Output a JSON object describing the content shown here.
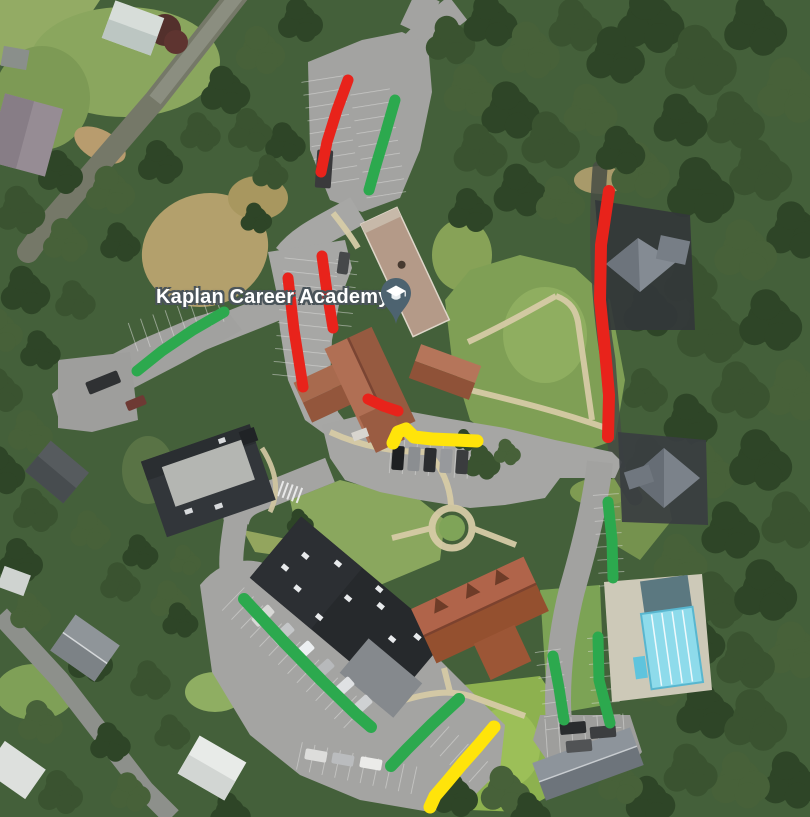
{
  "map": {
    "type": "satellite-imagery",
    "place": {
      "label": "Kaplan Career Academy",
      "label_x": 156,
      "label_y": 286,
      "label_color": "#ffffff",
      "label_halo": "#4a545a",
      "marker_icon": "graduation-cap",
      "marker_color": "#4d6370",
      "marker_x": 380,
      "marker_y": 277
    }
  },
  "annotations": {
    "colors": {
      "red": "#e8231b",
      "green": "#2ca94e",
      "yellow": "#ffe40a"
    },
    "stroke_width": 11,
    "lines": [
      {
        "id": "red-upper-lot",
        "color": "red",
        "width": 11,
        "points": [
          [
            348,
            80
          ],
          [
            337,
            110
          ],
          [
            327,
            142
          ],
          [
            321,
            172
          ]
        ]
      },
      {
        "id": "red-front-row-east",
        "color": "red",
        "width": 11,
        "points": [
          [
            322,
            256
          ],
          [
            327,
            292
          ],
          [
            333,
            328
          ]
        ]
      },
      {
        "id": "red-front-row-west",
        "color": "red",
        "width": 11,
        "points": [
          [
            288,
            278
          ],
          [
            294,
            330
          ],
          [
            303,
            387
          ]
        ]
      },
      {
        "id": "red-school-south",
        "color": "red",
        "width": 11,
        "points": [
          [
            368,
            399
          ],
          [
            383,
            406
          ],
          [
            398,
            411
          ]
        ]
      },
      {
        "id": "red-east-drive",
        "color": "red",
        "width": 12,
        "points": [
          [
            609,
            191
          ],
          [
            601,
            245
          ],
          [
            600,
            300
          ],
          [
            605,
            350
          ],
          [
            609,
            395
          ],
          [
            608,
            437
          ]
        ]
      },
      {
        "id": "green-upper-lot",
        "color": "green",
        "width": 11,
        "points": [
          [
            395,
            100
          ],
          [
            385,
            135
          ],
          [
            376,
            165
          ],
          [
            369,
            190
          ]
        ]
      },
      {
        "id": "green-west-row",
        "color": "green",
        "width": 11,
        "points": [
          [
            224,
            312
          ],
          [
            193,
            330
          ],
          [
            162,
            351
          ],
          [
            137,
            371
          ]
        ]
      },
      {
        "id": "green-east-row-upper",
        "color": "green",
        "width": 11,
        "points": [
          [
            608,
            502
          ],
          [
            612,
            540
          ],
          [
            613,
            578
          ]
        ]
      },
      {
        "id": "green-lower-lot-long",
        "color": "green",
        "width": 12,
        "points": [
          [
            244,
            599
          ],
          [
            283,
            641
          ],
          [
            322,
            681
          ],
          [
            356,
            714
          ],
          [
            371,
            727
          ]
        ]
      },
      {
        "id": "green-lower-curve",
        "color": "green",
        "width": 12,
        "points": [
          [
            459,
            699
          ],
          [
            432,
            724
          ],
          [
            407,
            749
          ],
          [
            391,
            766
          ]
        ]
      },
      {
        "id": "green-pool-row-west",
        "color": "green",
        "width": 11,
        "points": [
          [
            553,
            656
          ],
          [
            559,
            688
          ],
          [
            564,
            720
          ]
        ]
      },
      {
        "id": "green-pool-row-east",
        "color": "green",
        "width": 11,
        "points": [
          [
            598,
            637
          ],
          [
            599,
            680
          ],
          [
            610,
            723
          ]
        ]
      },
      {
        "id": "yellow-central",
        "color": "yellow",
        "width": 13,
        "points": [
          [
            393,
            443
          ],
          [
            398,
            432
          ],
          [
            406,
            429
          ],
          [
            414,
            437
          ],
          [
            432,
            439
          ],
          [
            455,
            440
          ],
          [
            477,
            441
          ]
        ]
      },
      {
        "id": "yellow-lower",
        "color": "yellow",
        "width": 13,
        "points": [
          [
            494,
            727
          ],
          [
            478,
            746
          ],
          [
            462,
            764
          ],
          [
            447,
            782
          ],
          [
            435,
            796
          ],
          [
            430,
            807
          ]
        ]
      }
    ]
  }
}
